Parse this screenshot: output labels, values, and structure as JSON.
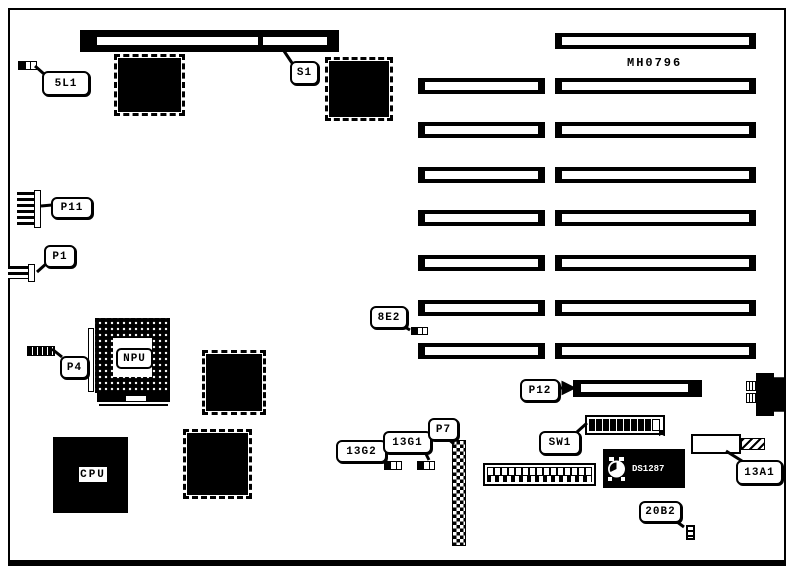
{
  "diagram": {
    "type": "motherboard-layout-diagram",
    "board_code": "MH0796",
    "slots": {
      "left_column_count": 7,
      "right_column_count": 8,
      "top_slot_count": 1,
      "p12_slot_count": 1
    }
  },
  "callouts": {
    "c_5l1": "5L1",
    "c_s1": "S1",
    "c_p11": "P11",
    "c_p1": "P1",
    "c_p4": "P4",
    "c_8e2": "8E2",
    "c_p12": "P12",
    "c_sw1": "SW1",
    "c_13g2": "13G2",
    "c_13g1": "13G1",
    "c_p7": "P7",
    "c_13a1": "13A1",
    "c_20b2": "20B2"
  },
  "chips": {
    "cpu": "CPU",
    "npu": "NPU",
    "rtc_line1": "DALLAS",
    "rtc_line2": "DS1287",
    "rtc_line3": "REAL TIME"
  },
  "colors": {
    "ink": "#000000",
    "paper": "#ffffff"
  }
}
